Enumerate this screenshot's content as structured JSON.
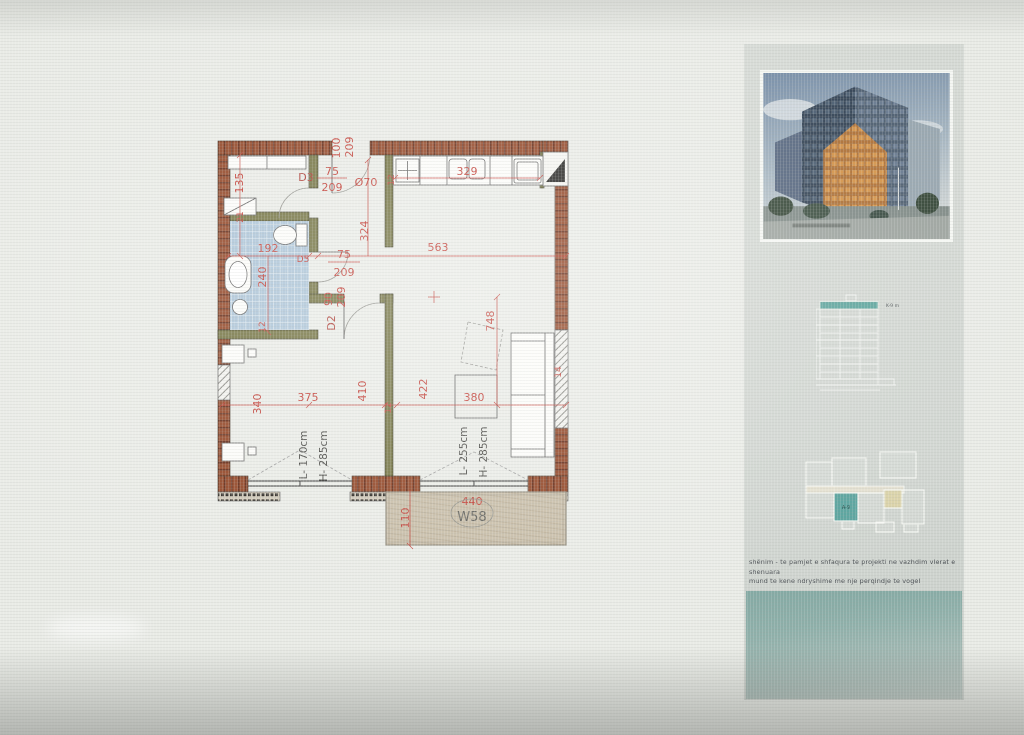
{
  "plan": {
    "colors": {
      "wall": "#8e3f1e",
      "partition": "#6f6f3c",
      "dim_red": "#bf352c",
      "tile_blue": "#a9c2d6",
      "balcony_tan": "#c7bca6"
    },
    "entry": {
      "width": "100",
      "height": "209"
    },
    "doors": {
      "d3": {
        "label": "D3",
        "width": "75",
        "height": "209"
      },
      "d5": {
        "label": "D5",
        "width": "75",
        "height": "209"
      },
      "d2": {
        "label": "D2",
        "width": "90",
        "height": "209"
      }
    },
    "fixtures": {
      "boiler": "Ø70"
    },
    "dims": {
      "hall_height": "135",
      "tick21": "21",
      "bath_width": "192",
      "bath_depth": "240",
      "bath_wall": "12",
      "hall_depth": "324",
      "living_width": "563",
      "top_wall": "12",
      "kitchen_run": "329",
      "living_depth": "748",
      "right_wall": "14",
      "bed_depth": "340",
      "bed_width": "375",
      "bed_wall": "410",
      "mid_wall": "12",
      "living_len": "422",
      "living_span": "380"
    },
    "windows": {
      "w1": {
        "l": "L- 170cm",
        "h": "H- 285cm"
      },
      "w2": {
        "l": "L- 255cm",
        "h": "H- 285cm"
      }
    },
    "balcony": {
      "width": "440",
      "id": "W58",
      "depth": "110"
    }
  },
  "sidebar": {
    "elevation_label": "K-9 m",
    "keyplan_label": "A-9",
    "note_line1": "shënim - te pamjet e shfaqura te projekti ne vazhdim  vlerat e shenuara",
    "note_line2": "mund te kene ndryshime me nje perqindje te vogel"
  }
}
